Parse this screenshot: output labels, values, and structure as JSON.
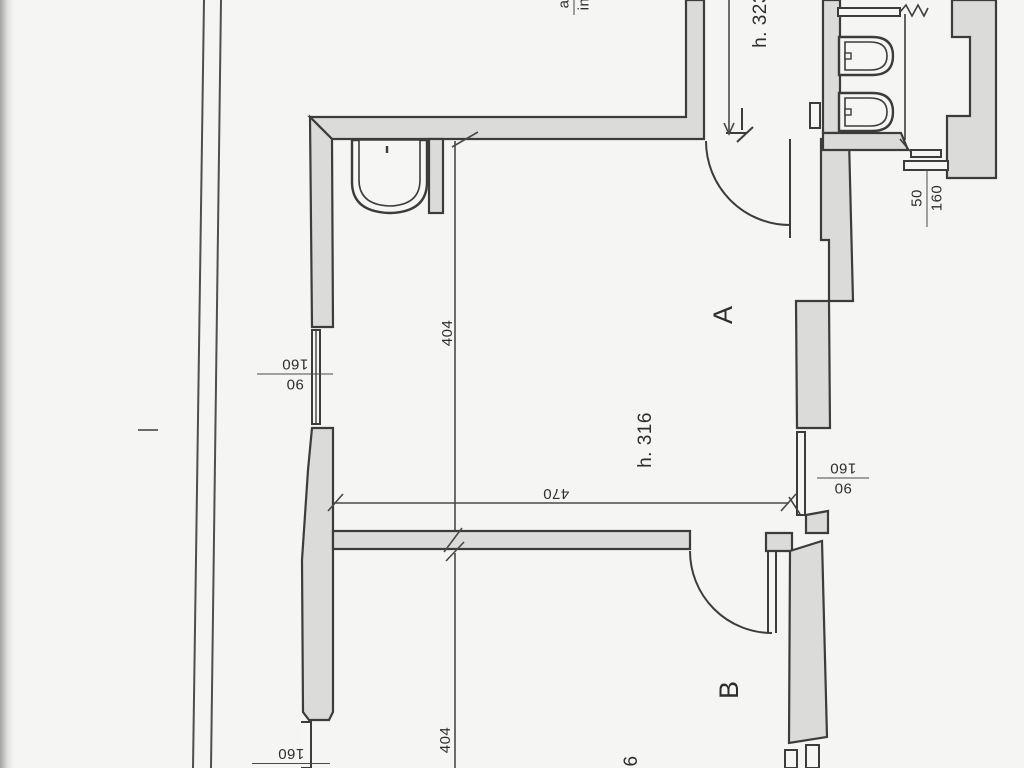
{
  "plan": {
    "colors": {
      "background": "#f5f5f3",
      "wall_fill": "#dbdbd9",
      "wall_stroke": "#3c3c3c",
      "dimension_line": "#4a4a4a",
      "text": "#2e2e2e"
    },
    "rooms": {
      "a": {
        "label": "A",
        "ceiling_height": "h. 316",
        "width_dim": "470",
        "depth_dim": "404"
      },
      "b": {
        "label": "B",
        "depth_dim": "404",
        "ceiling_height_partial": "6"
      }
    },
    "corridor": {
      "ceiling_height": "h. 323"
    },
    "entry": {
      "line1": "a",
      "line2": "in"
    },
    "windows": {
      "left": {
        "num": "90",
        "den": "160"
      },
      "right": {
        "num": "90",
        "den": "160"
      },
      "bath": {
        "num": "50",
        "den": "160"
      },
      "bottom": {
        "value": "160"
      }
    }
  }
}
